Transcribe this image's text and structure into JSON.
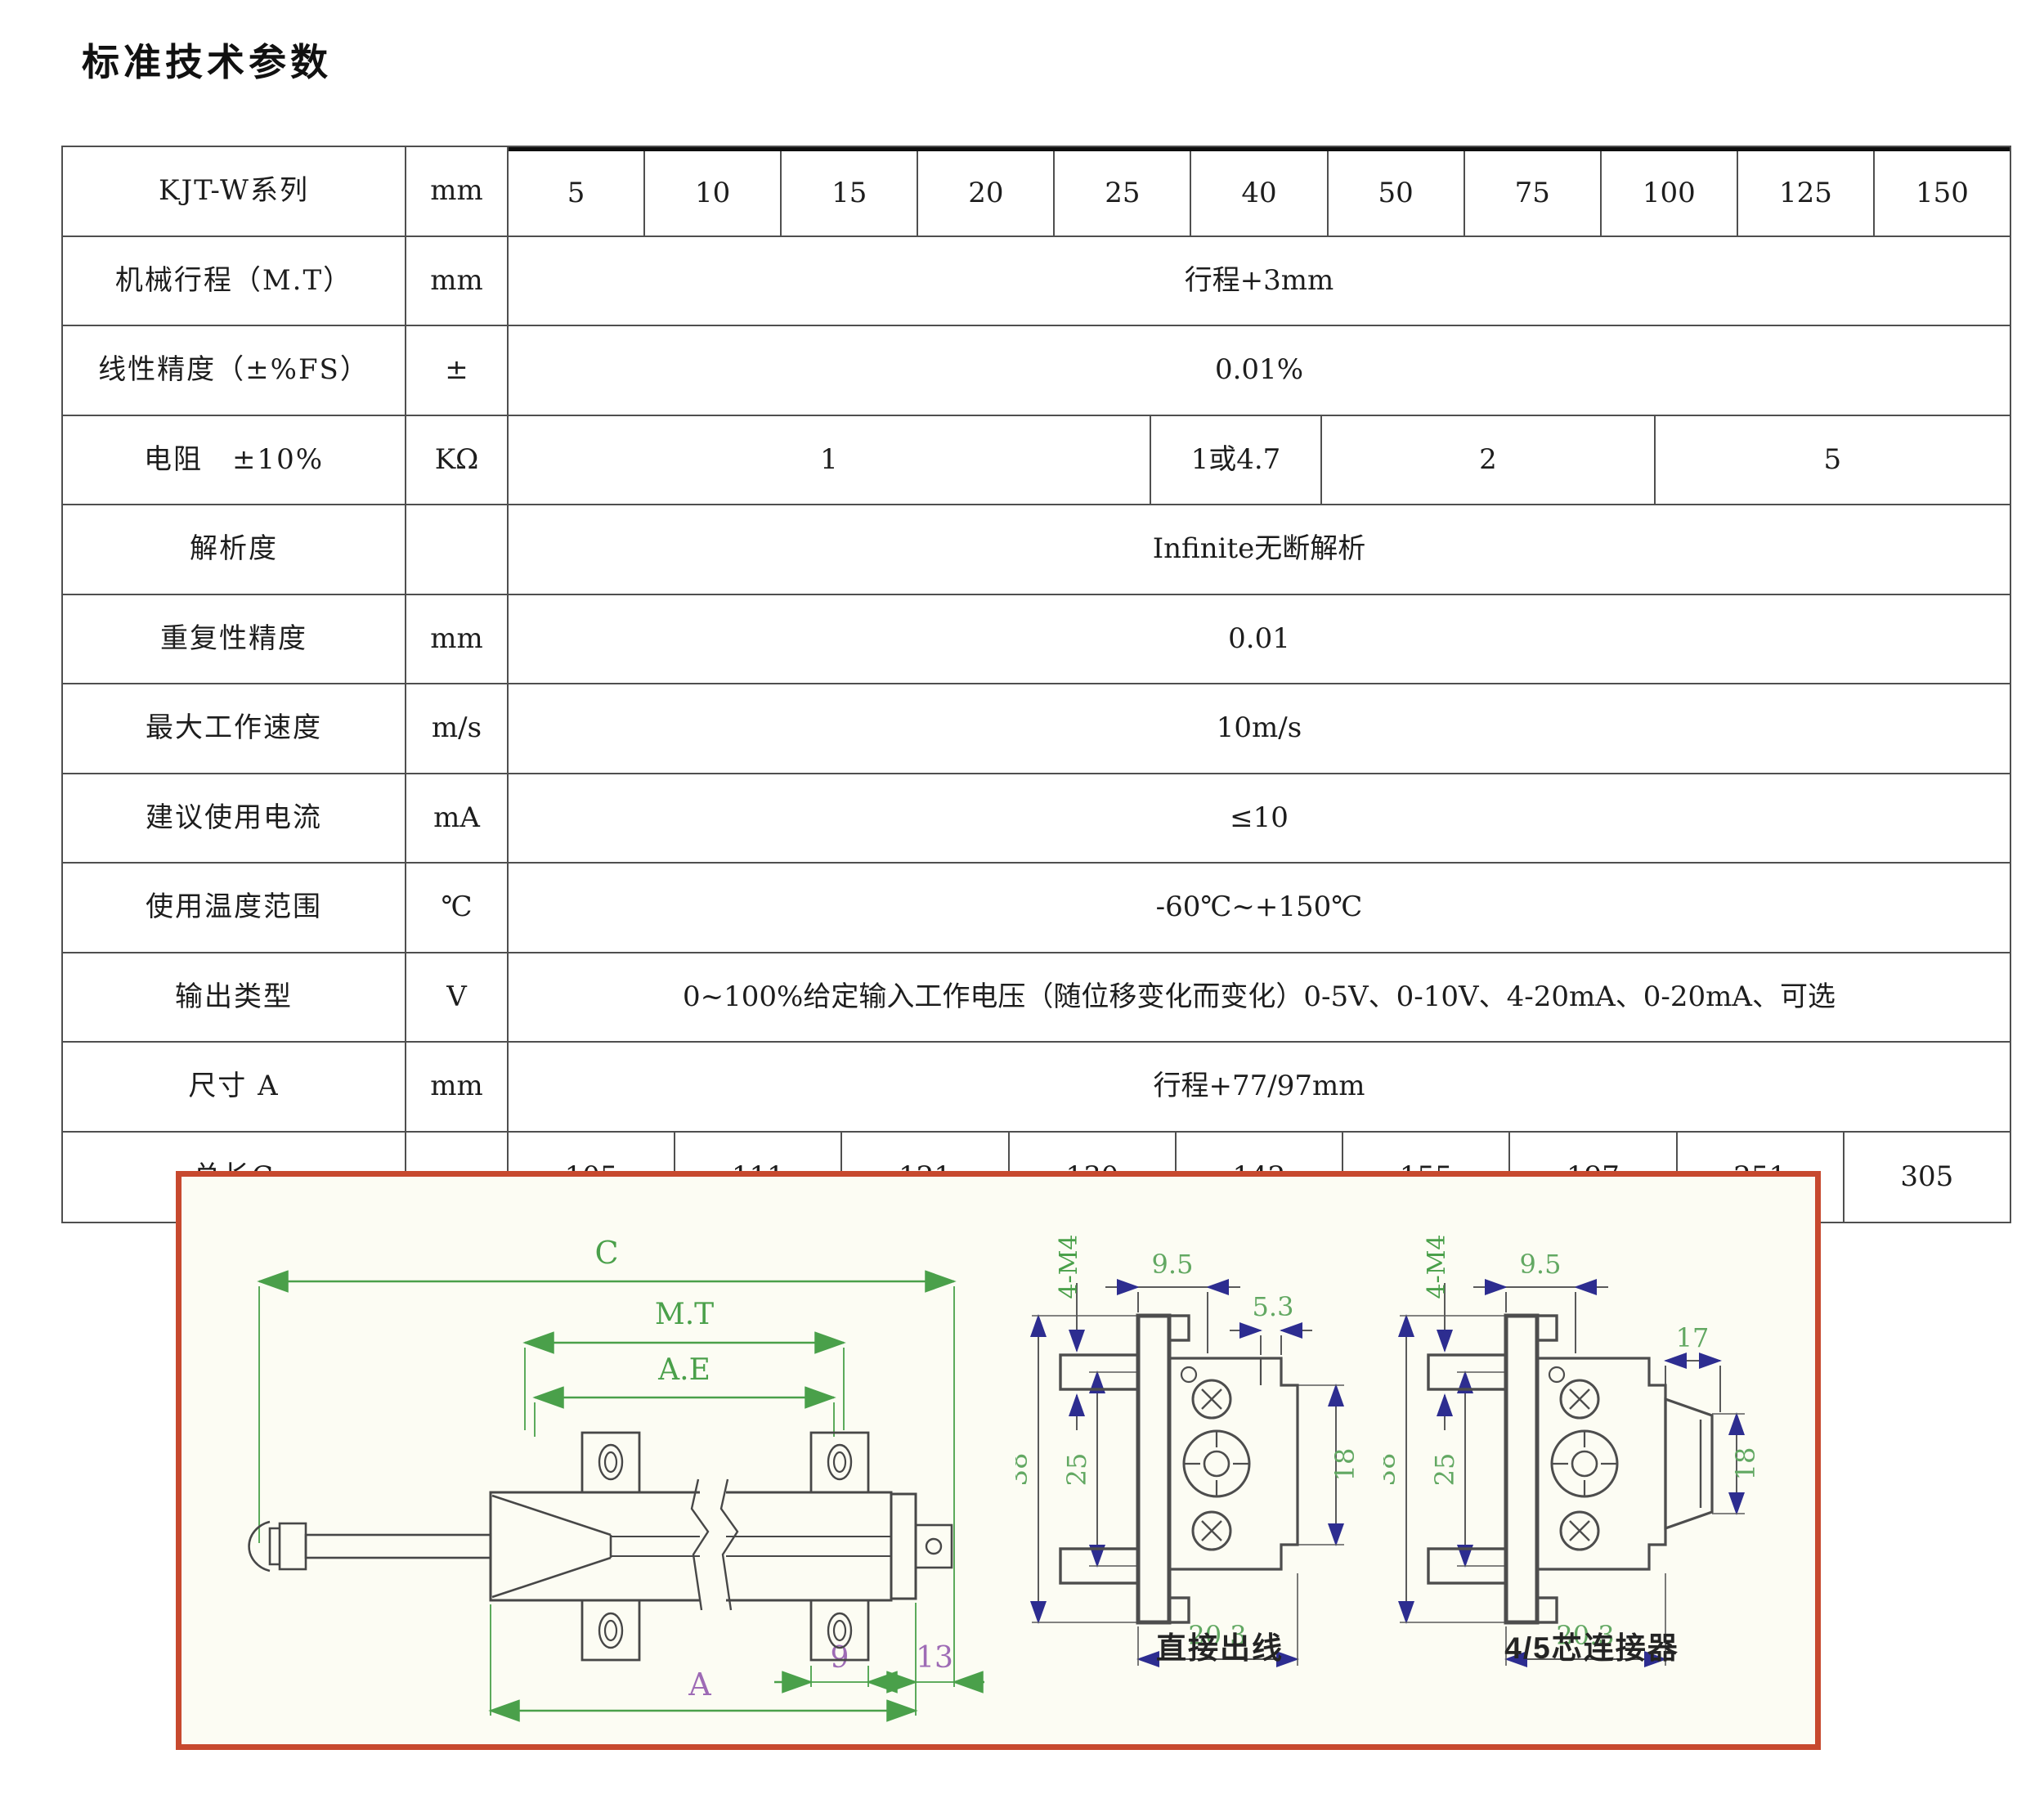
{
  "page": {
    "title": "标准技术参数"
  },
  "table": {
    "rows": [
      {
        "label": "KJT-W系列",
        "unit": "mm",
        "values": [
          "5",
          "10",
          "15",
          "20",
          "25",
          "40",
          "50",
          "75",
          "100",
          "125",
          "150"
        ]
      },
      {
        "label": "机械行程（M.T）",
        "unit": "mm",
        "value": "行程+3mm"
      },
      {
        "label": "线性精度（±%FS）",
        "unit": "±",
        "value": "0.01%"
      },
      {
        "label": "电阻　±10%",
        "unit": "KΩ",
        "values": [
          "1",
          "1或4.7",
          "2",
          "5"
        ]
      },
      {
        "label": "解析度",
        "unit": "",
        "value": "Infinite无断解析"
      },
      {
        "label": "重复性精度",
        "unit": "mm",
        "value": "0.01"
      },
      {
        "label": "最大工作速度",
        "unit": "m/s",
        "value": "10m/s"
      },
      {
        "label": "建议使用电流",
        "unit": "mA",
        "value": "≤10"
      },
      {
        "label": "使用温度范围",
        "unit": "℃",
        "value": "-60℃~+150℃"
      },
      {
        "label": "输出类型",
        "unit": "V",
        "value": "0~100%给定输入工作电压（随位移变化而变化）0-5V、0-10V、4-20mA、0-20mA、可选"
      },
      {
        "label": "尺寸 A",
        "unit": "mm",
        "value": "行程+77/97mm"
      },
      {
        "label": "总长C",
        "unit": "mm",
        "values": [
          "105",
          "111",
          "121",
          "130",
          "142",
          "155",
          "197",
          "251",
          "305"
        ]
      }
    ]
  },
  "diagram": {
    "side": {
      "c": "C",
      "mt": "M.T",
      "ae": "A.E",
      "a": "A",
      "n9": "9",
      "n13": "13"
    },
    "mid": {
      "m4": "4-M4",
      "w95": "9.5",
      "w53": "5.3",
      "h38": "38",
      "h25": "25",
      "h18": "18",
      "w203": "20.3",
      "caption": "直接出线"
    },
    "right": {
      "m4": "4-M4",
      "w95": "9.5",
      "w17": "17",
      "h38": "38",
      "h25": "25",
      "h18": "18",
      "w203": "20.3",
      "caption": "4/5芯连接器"
    }
  }
}
